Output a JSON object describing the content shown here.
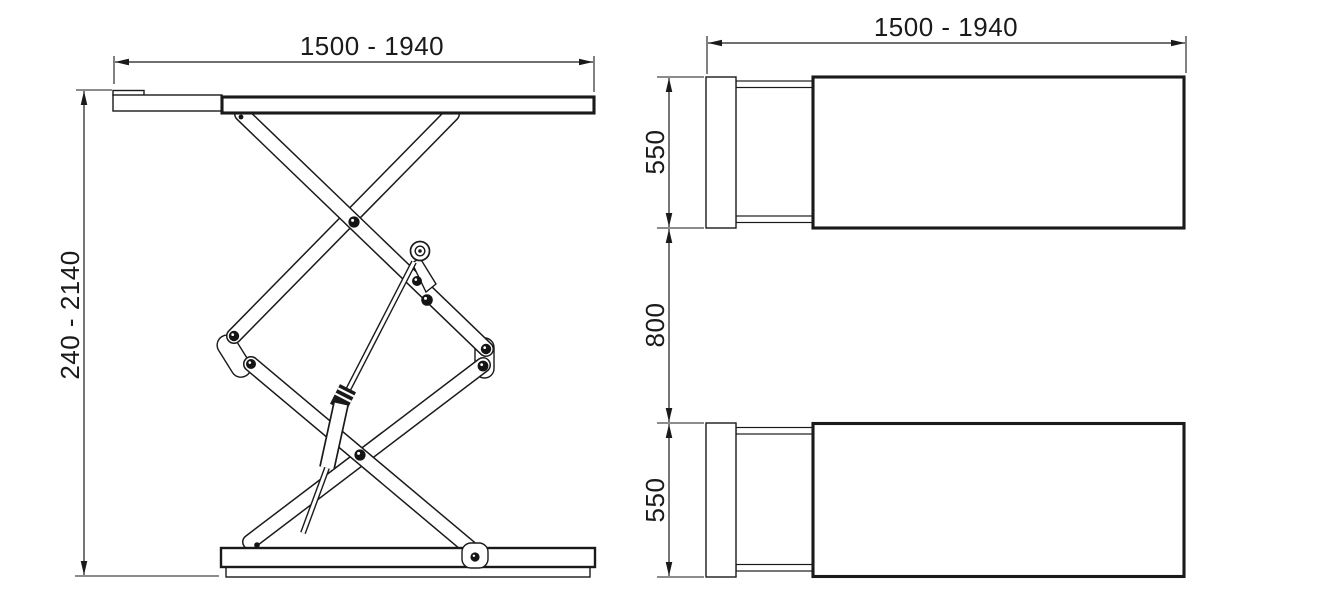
{
  "views": {
    "side_view": {
      "width_label": "1500 - 1940",
      "height_label": "240 - 2140"
    },
    "top_view": {
      "length_label": "1500 - 1940",
      "top_platform_width_label": "550",
      "gap_label": "800",
      "bottom_platform_width_label": "550"
    }
  },
  "colors": {
    "line": "#1a1a1a",
    "background": "#ffffff"
  }
}
